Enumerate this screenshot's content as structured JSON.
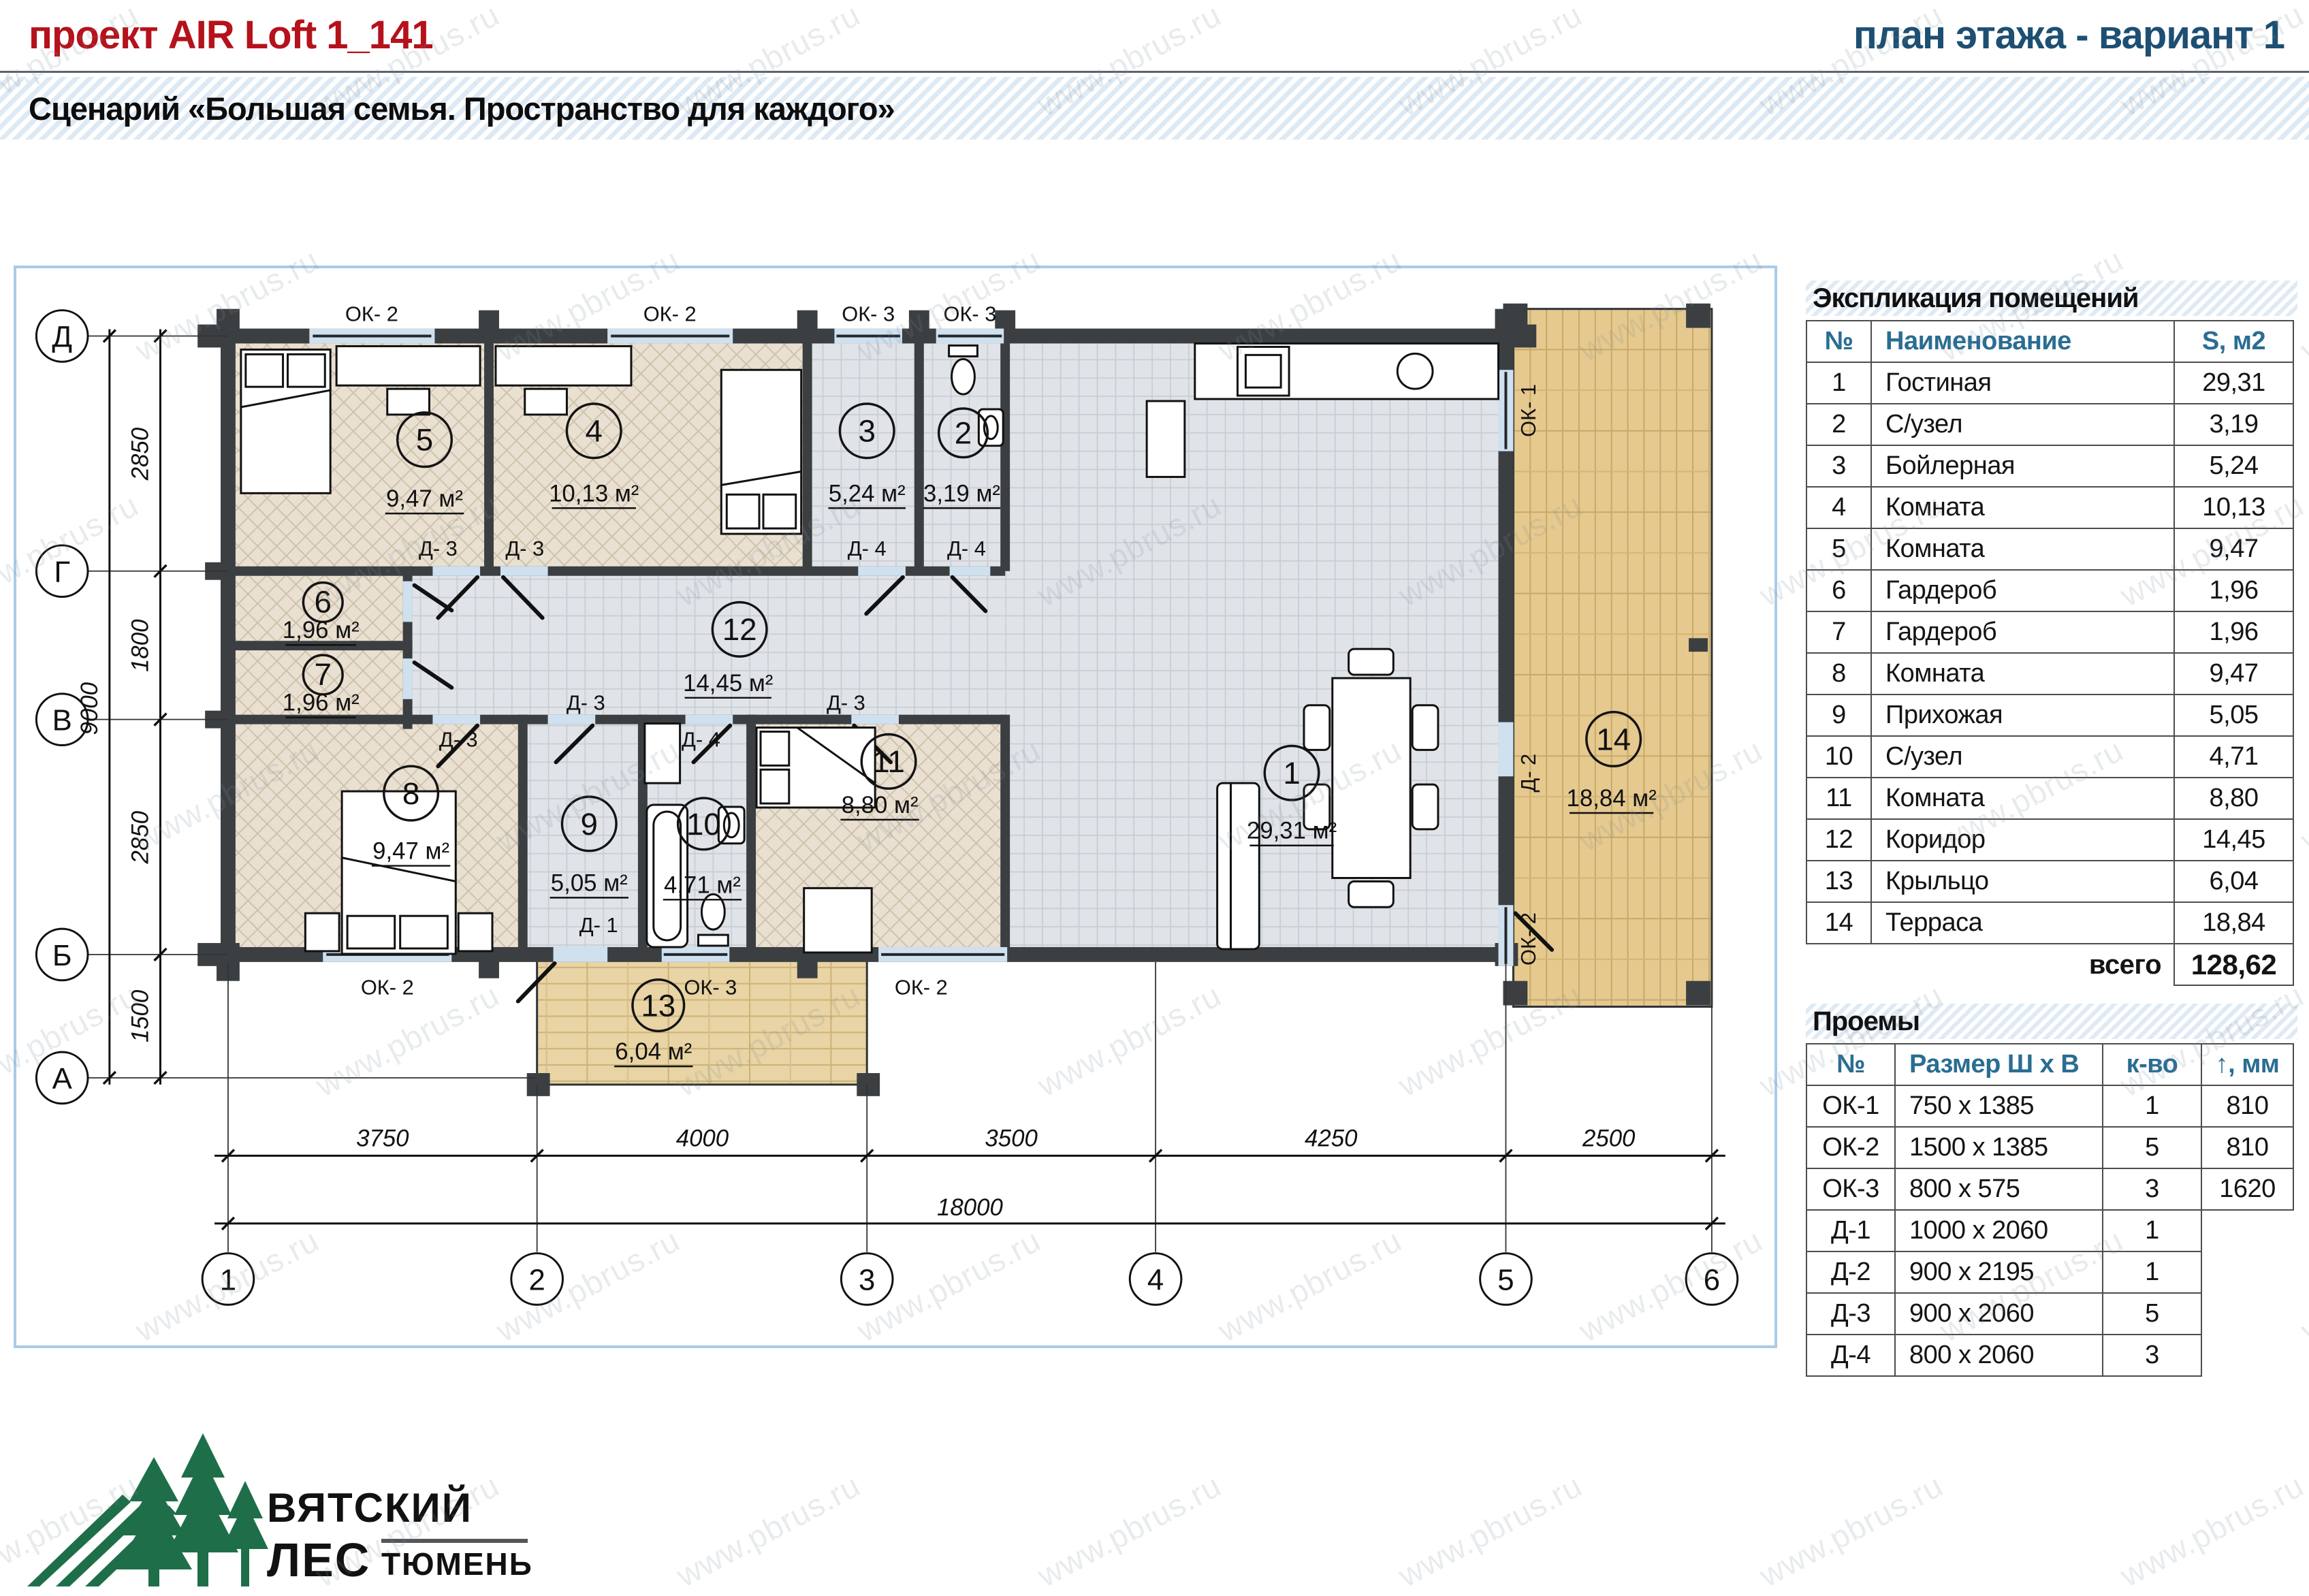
{
  "watermark": "www.pbrus.ru",
  "header": {
    "project_title": "проект AIR Loft 1_141",
    "page_title": "план этажа - вариант 1",
    "scenario_bar": "Сценарий «Большая семья. Пространство для каждого»"
  },
  "explication": {
    "title": "Экспликация помещений",
    "col_num": "№",
    "col_name": "Наименование",
    "col_area": "S, м2",
    "rows": [
      {
        "n": "1",
        "name": "Гостиная",
        "s": "29,31"
      },
      {
        "n": "2",
        "name": "С/узел",
        "s": "3,19"
      },
      {
        "n": "3",
        "name": "Бойлерная",
        "s": "5,24"
      },
      {
        "n": "4",
        "name": "Комната",
        "s": "10,13"
      },
      {
        "n": "5",
        "name": "Комната",
        "s": "9,47"
      },
      {
        "n": "6",
        "name": "Гардероб",
        "s": "1,96"
      },
      {
        "n": "7",
        "name": "Гардероб",
        "s": "1,96"
      },
      {
        "n": "8",
        "name": "Комната",
        "s": "9,47"
      },
      {
        "n": "9",
        "name": "Прихожая",
        "s": "5,05"
      },
      {
        "n": "10",
        "name": "С/узел",
        "s": "4,71"
      },
      {
        "n": "11",
        "name": "Комната",
        "s": "8,80"
      },
      {
        "n": "12",
        "name": "Коридор",
        "s": "14,45"
      },
      {
        "n": "13",
        "name": "Крыльцо",
        "s": "6,04"
      },
      {
        "n": "14",
        "name": "Терраса",
        "s": "18,84"
      }
    ],
    "total_label": "всего",
    "total_value": "128,62"
  },
  "openings": {
    "title": "Проемы",
    "col_num": "№",
    "col_size": "Размер Ш х В",
    "col_qty": "к-во",
    "col_h": "↑, мм",
    "rows": [
      {
        "n": "ОК-1",
        "size": "750 х 1385",
        "qty": "1",
        "h": "810"
      },
      {
        "n": "ОК-2",
        "size": "1500 х 1385",
        "qty": "5",
        "h": "810"
      },
      {
        "n": "ОК-3",
        "size": "800 х 575",
        "qty": "3",
        "h": "1620"
      },
      {
        "n": "Д-1",
        "size": "1000 х 2060",
        "qty": "1",
        "h": ""
      },
      {
        "n": "Д-2",
        "size": "900 х 2195",
        "qty": "1",
        "h": ""
      },
      {
        "n": "Д-3",
        "size": "900 х 2060",
        "qty": "5",
        "h": ""
      },
      {
        "n": "Д-4",
        "size": "800 х 2060",
        "qty": "3",
        "h": ""
      }
    ]
  },
  "plan": {
    "rooms": [
      {
        "n": "1",
        "area": "29,31 м²"
      },
      {
        "n": "2",
        "area": "3,19 м²"
      },
      {
        "n": "3",
        "area": "5,24 м²"
      },
      {
        "n": "4",
        "area": "10,13 м²"
      },
      {
        "n": "5",
        "area": "9,47 м²"
      },
      {
        "n": "6",
        "area": "1,96 м²"
      },
      {
        "n": "7",
        "area": "1,96 м²"
      },
      {
        "n": "8",
        "area": "9,47 м²"
      },
      {
        "n": "9",
        "area": "5,05 м²"
      },
      {
        "n": "10",
        "area": "4,71 м²"
      },
      {
        "n": "11",
        "area": "8,80 м²"
      },
      {
        "n": "12",
        "area": "14,45 м²"
      },
      {
        "n": "13",
        "area": "6,04 м²"
      },
      {
        "n": "14",
        "area": "18,84 м²"
      }
    ],
    "labels": {
      "ok1": "ОК- 1",
      "ok2": "ОК- 2",
      "ok3": "ОК- 3",
      "d1": "Д- 1",
      "d2": "Д- 2",
      "d3": "Д- 3",
      "d4": "Д- 4"
    },
    "axes_h": [
      "1",
      "2",
      "3",
      "4",
      "5",
      "6"
    ],
    "axes_v": [
      "Д",
      "Г",
      "В",
      "Б",
      "А"
    ],
    "dims_bottom": [
      "3750",
      "4000",
      "3500",
      "4250",
      "2500"
    ],
    "dim_total_bottom": "18000",
    "dims_left": [
      "2850",
      "1800",
      "2850",
      "1500"
    ],
    "dim_total_left": "9000"
  },
  "logo": {
    "line1": "ВЯТСКИЙ",
    "line2": "ЛЕС",
    "city": "ТЮМЕНЬ"
  }
}
